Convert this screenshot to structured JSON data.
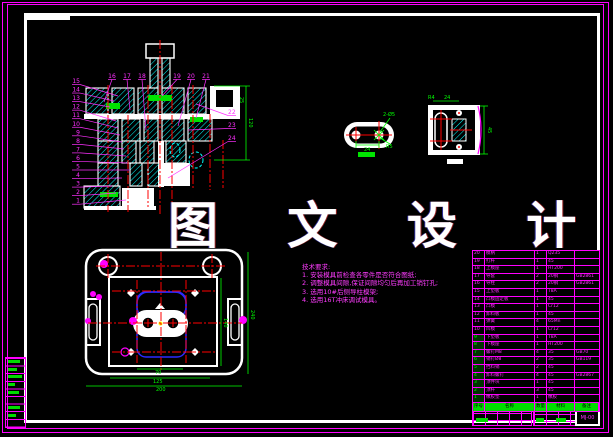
{
  "meta": {
    "background": "#000000",
    "border_color": "#ff00ff",
    "frame_color": "#ffffff",
    "hatch_color": "#00ffff",
    "centerline_color": "#ff0000",
    "dimension_color": "#00ff00",
    "callout_color": "#ff2fff",
    "insert_outline_color": "#2a2aff",
    "marker_color": "#ffff00"
  },
  "watermark": {
    "text": "图 文 设 计"
  },
  "tech_requirements": {
    "title": "技术要求:",
    "items": [
      "1. 安装模具前检查各零件是否符合图纸;",
      "2. 调整模具间隙,保证间隙均匀后再加工销钉孔;",
      "3. 选用10#后侧导柱模架;",
      "4. 选用16T冲床调试模具。"
    ]
  },
  "section_view": {
    "callouts_left": [
      "15",
      "14",
      "13",
      "12",
      "11",
      "10",
      "9",
      "8",
      "7",
      "6",
      "5",
      "4",
      "3",
      "2",
      "1"
    ],
    "callouts_top": [
      "16",
      "17",
      "18",
      "19",
      "20",
      "21"
    ],
    "callouts_right": [
      "22",
      "23",
      "24"
    ],
    "dims": {
      "right": "120",
      "right_small": "25"
    }
  },
  "plan_view": {
    "dims": {
      "right_outer": "240",
      "right_inner": "140",
      "bottom_inner": "70",
      "bottom_mid": "125",
      "bottom_outer": "200"
    }
  },
  "part_views": {
    "part1": {
      "dims": {
        "width": "24",
        "holes": "2-Ø5",
        "radius": "R5"
      }
    },
    "part2": {
      "dims": {
        "radius": "R4",
        "width": "24",
        "height": "45"
      }
    }
  },
  "bom": {
    "headers": [
      "序号",
      "名称",
      "数量",
      "材料",
      "备注"
    ],
    "rows": [
      [
        "20",
        "模柄",
        "1",
        "Q235",
        ""
      ],
      [
        "19",
        "打杆",
        "1",
        "45",
        ""
      ],
      [
        "18",
        "上模座",
        "1",
        "HT200",
        ""
      ],
      [
        "17",
        "导套",
        "2",
        "20钢",
        "GB2861"
      ],
      [
        "16",
        "导柱",
        "2",
        "20钢",
        "GB2861"
      ],
      [
        "15",
        "上垫板",
        "1",
        "T8A",
        ""
      ],
      [
        "14",
        "凸模固定板",
        "1",
        "45",
        ""
      ],
      [
        "13",
        "凸模",
        "1",
        "Cr12",
        ""
      ],
      [
        "12",
        "卸料板",
        "1",
        "45",
        ""
      ],
      [
        "11",
        "弹簧",
        "4",
        "65Mn",
        ""
      ],
      [
        "10",
        "凹模",
        "1",
        "Cr12",
        ""
      ],
      [
        "9",
        "下垫板",
        "1",
        "T8A",
        ""
      ],
      [
        "8",
        "下模座",
        "1",
        "HT200",
        ""
      ],
      [
        "7",
        "螺钉M8",
        "4",
        "35",
        "GB70"
      ],
      [
        "6",
        "销钉Ø8",
        "2",
        "35",
        "GB119"
      ],
      [
        "5",
        "挡料销",
        "2",
        "45",
        ""
      ],
      [
        "4",
        "卸料螺钉",
        "4",
        "45",
        "GB2867"
      ],
      [
        "3",
        "顶件块",
        "1",
        "45",
        ""
      ],
      [
        "2",
        "顶杆",
        "3",
        "45",
        ""
      ],
      [
        "1",
        "橡胶垫",
        "1",
        "橡胶",
        ""
      ]
    ]
  },
  "title_block": {
    "spec": "HB2  b=1.8",
    "drawing_no": "MJ-00"
  }
}
